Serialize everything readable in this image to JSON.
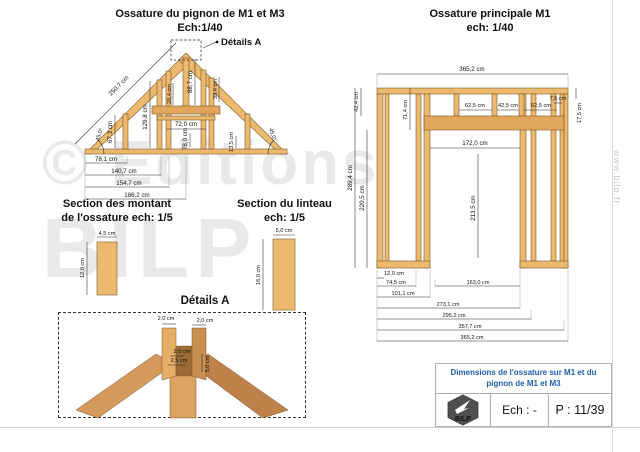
{
  "page": {
    "watermark_line1": "© Editions",
    "watermark_line2": "BILP",
    "site_vertical": "www.bilp.fr"
  },
  "pignon": {
    "title": "Ossature du pignon de M1 et M3",
    "scale": "Ech:1/40",
    "detail_callout": "Détails A",
    "dims": {
      "slope": "250,7 cm",
      "angle_left": "45,0°",
      "angle_right": "45,0°",
      "stud_left": "67,3 cm",
      "stud_mid": "129,8 cm",
      "collar": "28,4 cm",
      "ridge": "88,7 cm",
      "right_upper": "39,4 cm",
      "opening_width": "72,0 cm",
      "opening_height": "78,0 cm",
      "right_lower": "13,5 cm",
      "base1": "78,1 cm",
      "base2": "140,7 cm",
      "base3": "154,7 cm",
      "base4": "186,2 cm"
    }
  },
  "principale": {
    "title": "Ossature principale M1",
    "scale": "ech: 1/40",
    "dims": {
      "top_width": "365,2 cm",
      "top_left": "42,4 cm",
      "height": "289,4 cm",
      "left_lower": "220,5 cm",
      "stud_top": "71,4 cm",
      "bay1": "62,5 cm",
      "bay2": "42,5 cm",
      "bay3": "62,5 cm",
      "opening_width": "172,0 cm",
      "opening_height": "213,5 cm",
      "right_gap": "7,5 cm",
      "right_upper": "17,5 cm",
      "base_plate": "12,0 cm",
      "b1": "74,5 cm",
      "b2": "163,0 cm",
      "b3": "101,1 cm",
      "b4": "273,1 cm",
      "b5": "295,2 cm",
      "b6": "357,7 cm",
      "b7": "365,2 cm"
    }
  },
  "sections": {
    "montant": {
      "title1": "Section des montant",
      "title2": "de l'ossature ech: 1/5",
      "w": "4,5 cm",
      "h": "12,0 cm"
    },
    "linteau": {
      "title1": "Section du linteau",
      "title2": "ech: 1/5",
      "w": "5,0 cm",
      "h": "16,0 cm"
    }
  },
  "details": {
    "title": "Détails A",
    "d1": "2,0 cm",
    "d2": "2,0 cm",
    "d3": "2,0 cm",
    "d4": "2,5 cm",
    "d5": "5,0 cm"
  },
  "titleblock": {
    "title1": "Dimensions de l'ossature sur M1 et du",
    "title2": "pignon de M1 et M3",
    "logo": "BILP",
    "scale": "Ech : -",
    "page": "P : 11/39"
  }
}
